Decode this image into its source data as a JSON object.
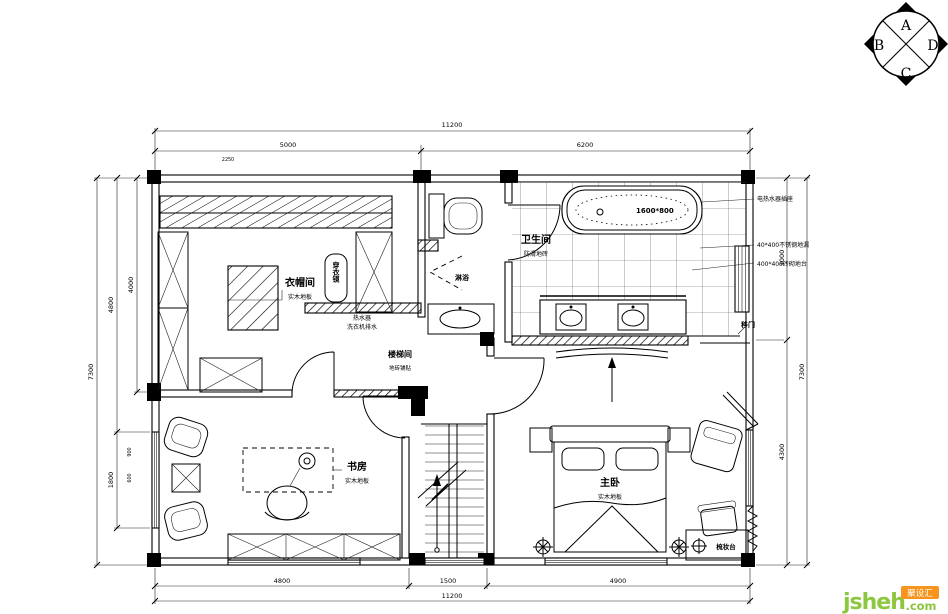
{
  "compass": {
    "top": "A",
    "left": "B",
    "bottom": "C",
    "right": "D"
  },
  "watermark": {
    "brand": "jsheh",
    "tld": ".com",
    "badge": "聚设汇",
    "green": "#8dc63f",
    "orange": "#f7941d"
  },
  "rooms": {
    "cloakroom": {
      "name": "衣帽间",
      "finish": "实木地板"
    },
    "bathroom": {
      "name": "卫生间",
      "finish": "防滑地砖"
    },
    "stairwell": {
      "name": "楼梯间",
      "finish": "地砖铺贴"
    },
    "study": {
      "name": "书房",
      "finish": "实木地板"
    },
    "master": {
      "name": "主卧",
      "finish": "实木地板"
    }
  },
  "labels": {
    "mirror": "穿衣镜",
    "shower": "淋浴",
    "tub_size": "1600*800",
    "sliding_door": "移门",
    "dresser": "梳妆台",
    "note_heater": "电热水器插座",
    "note_drain": "40*400不锈钢地漏",
    "note_platform": "400*400砖砌地台",
    "note_water_1": "热水器",
    "note_water_2": "洗衣机排水"
  },
  "dimensions": {
    "top_total": "11200",
    "top_seg1": "5000",
    "top_seg2": "6200",
    "closet_top": "2250",
    "bottom_seg1": "4800",
    "bottom_seg2": "1500",
    "bottom_seg3": "4900",
    "bottom_total": "11200",
    "left_inner": "4000",
    "left_mid": "4800",
    "left_outer": "7300",
    "left_window": "1800",
    "left_tiny1": "900",
    "left_tiny2": "600",
    "right_top": "3000",
    "right_bottom": "4300",
    "right_outer": "7300"
  }
}
